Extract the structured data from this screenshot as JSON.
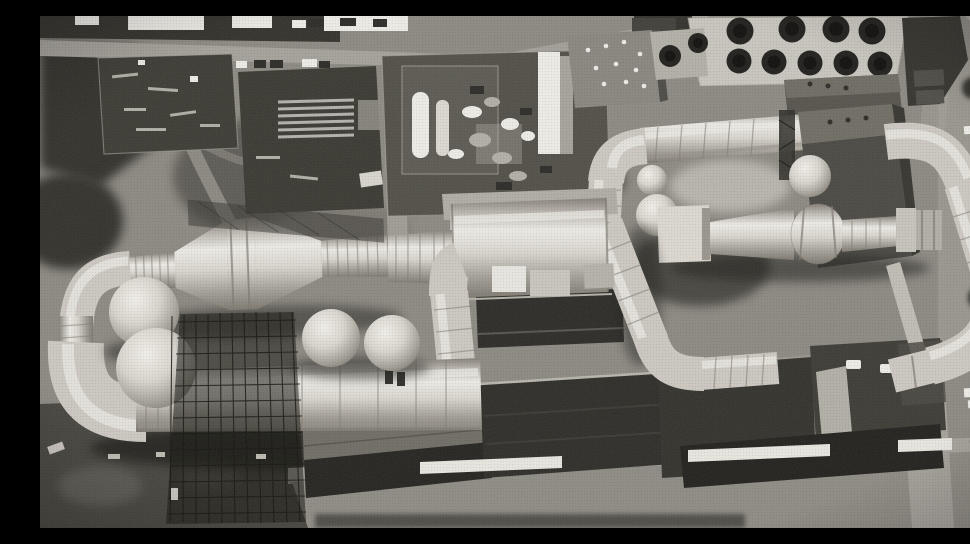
{
  "meta": {
    "alt": "Black-and-white aerial photograph of a large wind tunnel test facility: looping light-colored ducts with ringed joints, spherical pressure tanks, a scaffolded tower, cooling tower cells, dark flat-roofed test buildings, storage yards, roads and parked vehicles",
    "photo_style": "halftone print, grayscale, oblique aerial view"
  },
  "palette": {
    "ground": "#8c8981",
    "groundLight": "#a29f96",
    "veg": "#31302a",
    "vegLight": "#4a4841",
    "shadow": "#1d1c18",
    "road": "#a5a29a",
    "roadBright": "#e9e7e0",
    "white": "#efede7",
    "duct": "#cdc9c1",
    "ductHi": "#ebe9e3",
    "ductLo": "#97938a",
    "ductEdge": "#7d7970",
    "bldgDark": "#2a2925",
    "bldgMid": "#4a4842",
    "bldgLight": "#6f6c63",
    "pad": "#c9c6be",
    "cell": "#1e1d1a",
    "wall": "#c0bdb4"
  },
  "scene": {
    "facility_elements": [
      {
        "name": "test-section-duct",
        "description": "large horizontal cylindrical test section at center"
      },
      {
        "name": "left-cone-duct",
        "description": "ringed conical duct narrowing toward left elbow"
      },
      {
        "name": "return-leg-duct",
        "description": "long ringed duct along lower left, passing through scaffold"
      },
      {
        "name": "scaffold-tower",
        "description": "dark lattice scaffolding around duct under construction"
      },
      {
        "name": "sphere-tanks",
        "description": "two large and two medium spherical tanks"
      },
      {
        "name": "upper-right-duct-loop",
        "description": "elevated duct running right into ringed elbow and diagonal return"
      },
      {
        "name": "nozzle-assembly",
        "description": "flanged nozzle/diffuser train at center right"
      },
      {
        "name": "drive-motor-building",
        "description": "tall dark box building on right"
      },
      {
        "name": "cooling-tower",
        "description": "light pad with two rows of dark circular fan cells"
      },
      {
        "name": "compressor-plant-yard",
        "description": "fenced yard with machinery and white vessels"
      },
      {
        "name": "storage-yards",
        "description": "dark laydown yards with stacked pipe and debris"
      },
      {
        "name": "test-buildings",
        "description": "long dark flat-roofed buildings along bottom"
      },
      {
        "name": "roads",
        "description": "light roads top and bottom with white crossings"
      },
      {
        "name": "vehicles",
        "description": "trucks parked along top road, cars at lower right"
      }
    ],
    "counts": {
      "cooling_cells_row1": 4,
      "cooling_cells_row2": 5,
      "cooling_cells_extra": 2,
      "large_spheres": 2,
      "medium_spheres": 2,
      "small_spheres": 2,
      "white_roofed_buildings": 4,
      "roof_vents_building_c": 3,
      "parked_cars_white": 3,
      "parked_cars_dark": 3,
      "trucks_top": 6
    }
  }
}
